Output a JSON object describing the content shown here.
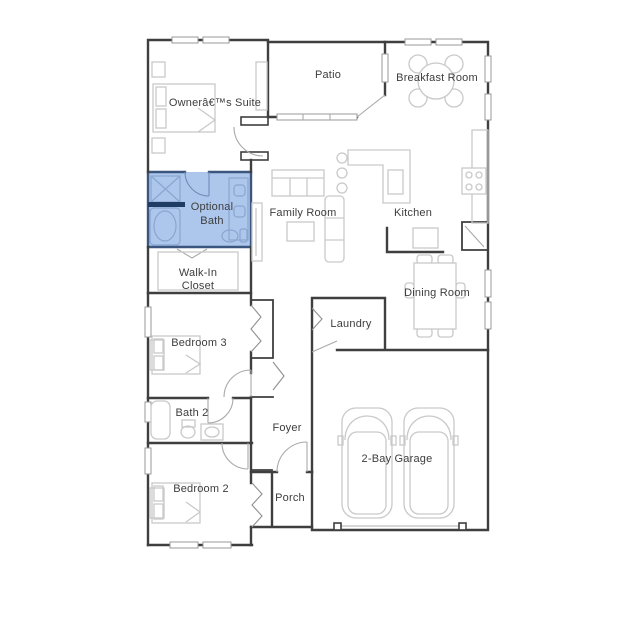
{
  "title": "Floor plan",
  "colors": {
    "highlight_fill": "#adc7ec",
    "highlight_bar": "#1e3c64",
    "wall": "#3f3f3f",
    "bath_wall": "#3a567e",
    "furniture": "#c9c9c9",
    "label_text": "#3d3d3d"
  },
  "rooms": {
    "owners_suite": {
      "label": "Ownerâ€™s Suite"
    },
    "patio": {
      "label": "Patio"
    },
    "breakfast": {
      "label": "Breakfast Room"
    },
    "optional_bath": {
      "line1": "Optional",
      "line2": "Bath"
    },
    "family": {
      "label": "Family Room"
    },
    "kitchen": {
      "label": "Kitchen"
    },
    "walk_in_closet": {
      "line1": "Walk-In",
      "line2": "Closet"
    },
    "dining": {
      "label": "Dining Room"
    },
    "bedroom3": {
      "label": "Bedroom 3"
    },
    "laundry": {
      "label": "Laundry"
    },
    "bath2": {
      "label": "Bath 2"
    },
    "foyer": {
      "label": "Foyer"
    },
    "bedroom2": {
      "label": "Bedroom 2"
    },
    "porch": {
      "label": "Porch"
    },
    "garage": {
      "label": "2-Bay Garage"
    }
  }
}
